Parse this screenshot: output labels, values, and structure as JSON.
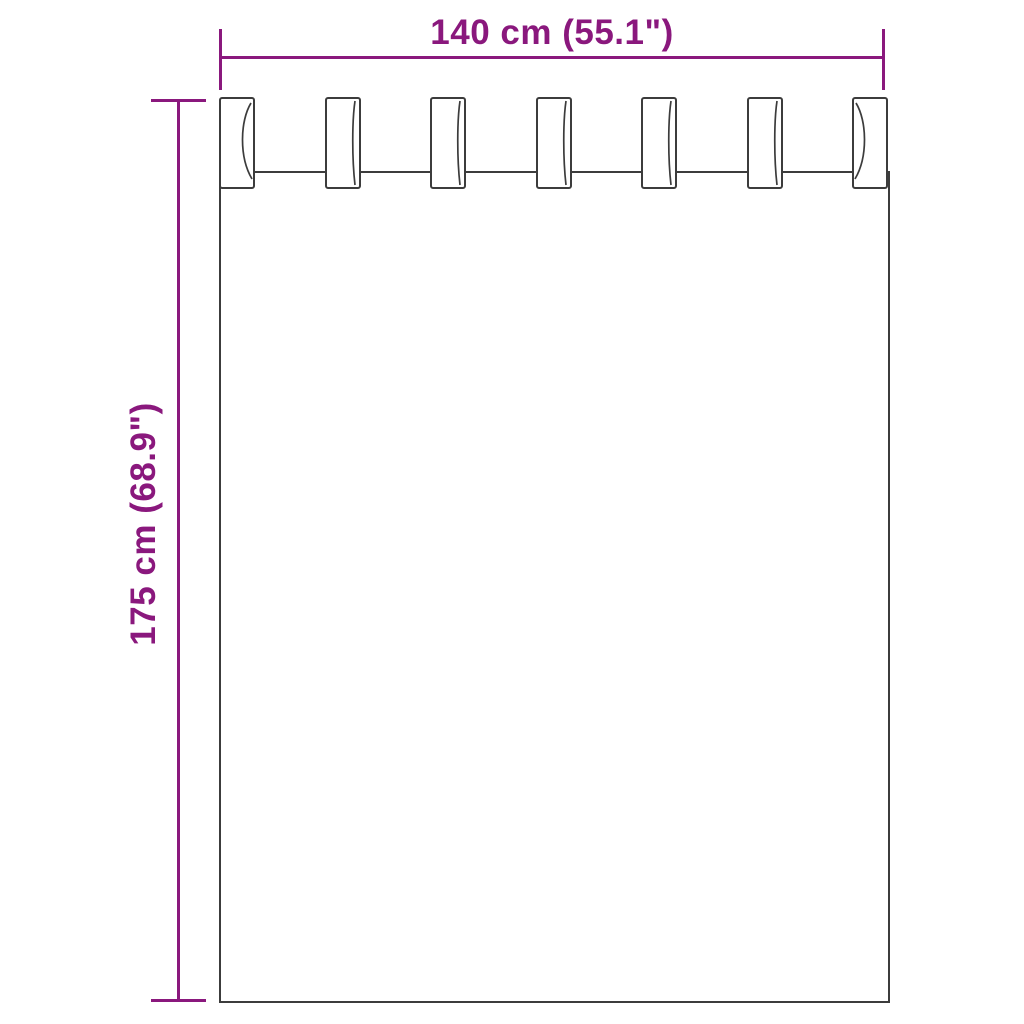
{
  "diagram": {
    "type": "product-dimension-diagram",
    "subject": "curtain with tab top loops",
    "colors": {
      "dimension_accent": "#8a187d",
      "outline": "#3c3c3c",
      "background": "#ffffff"
    },
    "width_dimension": {
      "label": "140 cm (55.1\")"
    },
    "height_dimension": {
      "label": "175 cm (68.9\")"
    },
    "curtain": {
      "tab_count": 7
    }
  }
}
